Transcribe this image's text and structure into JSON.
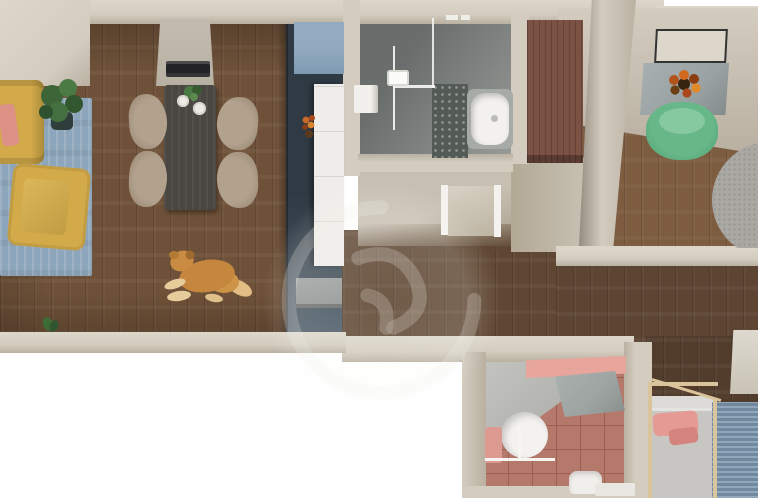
{
  "meta": {
    "kind": "3d-floor-plan-top-down-render",
    "description": "Photorealistic top-down 3D render of an apartment floor plan, no visible text",
    "canvas": {
      "width": 758,
      "height": 498
    }
  },
  "palette": {
    "outside": "#ffffff",
    "wall": "#d3ccbf",
    "wallLight": "#ddd7cb",
    "wallDark": "#b9b0a1",
    "wallEdge": "#979082",
    "woodLiving": "#6e5138",
    "woodHall": "#5f4733",
    "woodOffice": "#7d5c40",
    "woodCorridor": "#5d4533",
    "woodBedroom": "#523d2d",
    "rugBlue": "#8ea6bb",
    "sofaYellow": "#d2aa49",
    "sofaShadow": "#ad8b39",
    "pillowPink": "#dd9186",
    "plantGreen": "#3f6b3c",
    "plantPot": "#2f3d3b",
    "sideboard": "#b7b0a3",
    "tvDark": "#232327",
    "tableDark": "#4a4641",
    "chairBeige": "#b2a28d",
    "kitchenBlue": "#7e9ab2",
    "kitchenNavy": "#2f3a44",
    "kitchenNavyLight": "#4b5a66",
    "counter": "#efede9",
    "appliance": "#8e9191",
    "flameOrange": "#c96a2a",
    "bathFloorA": "#696d6c",
    "bathFloorB": "#9a9d99",
    "tileDeco": "#545a55",
    "tub": "#f2f1ed",
    "tubRim": "#a7aba8",
    "glass": "#f8f8f6",
    "wcFloor": "#c7c0b2",
    "door": "#f4f2ee",
    "wardrobe": "#7c5244",
    "desk": "#9aa1a2",
    "frameBorder": "#333333",
    "chairGreen": "#68b789",
    "chairGreenLight": "#86c8a0",
    "rugRound": "#a9a8a3",
    "sheet": "#dcdbd7",
    "mattress": "#c7c6c2",
    "bedPillow": "#e59b93",
    "bedPillowDark": "#d5837d",
    "canopy": "#d9c49b",
    "rugBedBlue": "#7d96ac",
    "tilePink": "#b5796c",
    "tileGrid": "#9a6053",
    "pinkWall": "#e7a59c",
    "partition": "#9ca3a1",
    "sink": "#f3f2ef",
    "dogBody": "#c5873e"
  },
  "rooms": [
    {
      "name": "living-room",
      "floor": "dark-wood-planks",
      "items": [
        "yellow-sofa",
        "salmon-pillow",
        "potted-plant",
        "blue-area-rug",
        "yellow-armchair",
        "dog-lying-on-floor",
        "small-leaf-plant"
      ]
    },
    {
      "name": "dining-area",
      "floor": "dark-wood-planks",
      "items": [
        "gray-sideboard",
        "flat-tv-on-sideboard",
        "dark-dining-table",
        "four-beige-shell-chairs",
        "two-white-plates",
        "small-table-plant"
      ]
    },
    {
      "name": "kitchen",
      "floor": "dark",
      "items": [
        "light-blue-backsplash-wall",
        "navy-cabinet-run",
        "white-countertop",
        "orange-flowers",
        "gray-appliance-block"
      ]
    },
    {
      "name": "bathroom-top",
      "floor": "gray-stone",
      "items": [
        "walk-in-shower",
        "glass-partition-lines",
        "shower-fixture",
        "patterned-tile-strip",
        "white-bathtub",
        "white-wall-shelf"
      ]
    },
    {
      "name": "hallway",
      "floor": "dark-wood-planks",
      "items": [
        "open-white-door",
        "reddish-brown-wardrobe",
        "faint-circular-watermark"
      ]
    },
    {
      "name": "office-room",
      "floor": "wood-planks",
      "items": [
        "dark-outlined-wall-frame",
        "gray-desk",
        "orange-flower-centerpiece",
        "green-armchair",
        "round-gray-rug-partial"
      ]
    },
    {
      "name": "corridor",
      "floor": "dark-wood-planks",
      "items": []
    },
    {
      "name": "bedroom",
      "floor": "dark-wood-planks",
      "items": [
        "wooden-canopy-frame",
        "bed-with-white-sheet",
        "pink-pillows",
        "blue-knit-rug",
        "light-wall-panel"
      ]
    },
    {
      "name": "ensuite-bathroom",
      "floor": "terracotta-tiles",
      "items": [
        "pink-accent-wall",
        "gray-partition-panel",
        "white-basin",
        "towel-rail",
        "pink-towel",
        "white-toilet",
        "white-tray"
      ]
    }
  ],
  "watermark": {
    "style": "faint-translucent-circular-logo",
    "position": "center-over-hallway"
  }
}
